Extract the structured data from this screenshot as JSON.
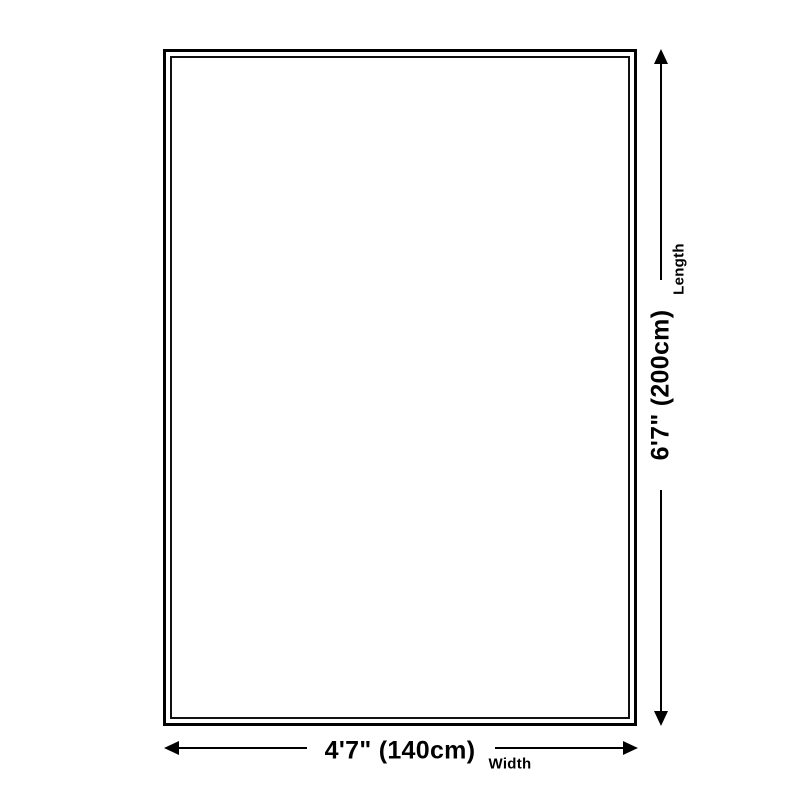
{
  "page": {
    "background_color": "#ffffff",
    "line_color": "#000000"
  },
  "diagram": {
    "type": "product-size-diagram",
    "length": {
      "value": "6'7\" (200cm)",
      "label": "Length"
    },
    "width": {
      "value": "4'7\" (140cm)",
      "label": "Width"
    }
  }
}
